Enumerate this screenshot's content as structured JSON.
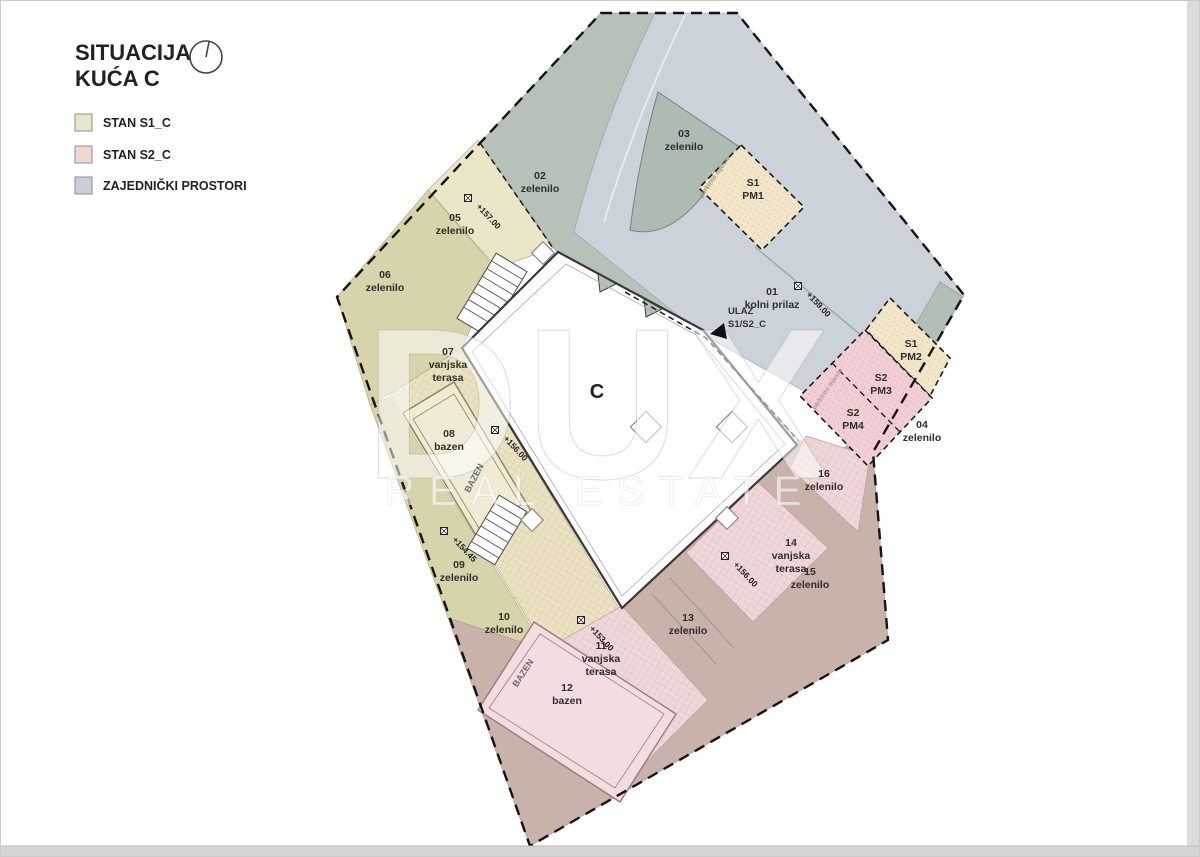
{
  "title": {
    "line1": "SITUACIJA",
    "line2": "KUĆA C"
  },
  "legend": {
    "items": [
      {
        "label": "STAN S1_C",
        "color": "#e9e5c9"
      },
      {
        "label": "STAN S2_C",
        "color": "#eed7d0"
      },
      {
        "label": "ZAJEDNIČKI PROSTORI",
        "color": "#c7cfd8"
      }
    ]
  },
  "watermark": {
    "line1": "DUX",
    "line2": "REAL ESTATE"
  },
  "building": {
    "label": "C"
  },
  "entrance": {
    "line1": "ULAZ",
    "line2": "S1/S2_C"
  },
  "pool_label": "BAZEN",
  "parking_note": "parkirno mjesto",
  "zones": {
    "z01": {
      "lines": [
        "01",
        "kolni prilaz"
      ]
    },
    "z02": {
      "lines": [
        "02",
        "zelenilo"
      ]
    },
    "z03": {
      "lines": [
        "03",
        "zelenilo"
      ]
    },
    "z04": {
      "lines": [
        "04",
        "zelenilo"
      ]
    },
    "z05": {
      "lines": [
        "05",
        "zelenilo"
      ]
    },
    "z06": {
      "lines": [
        "06",
        "zelenilo"
      ]
    },
    "z07": {
      "lines": [
        "07",
        "vanjska",
        "terasa"
      ]
    },
    "z08": {
      "lines": [
        "08",
        "bazen"
      ]
    },
    "z09": {
      "lines": [
        "09",
        "zelenilo"
      ]
    },
    "z10": {
      "lines": [
        "10",
        "zelenilo"
      ]
    },
    "z11": {
      "lines": [
        "11",
        "vanjska",
        "terasa"
      ]
    },
    "z12": {
      "lines": [
        "12",
        "bazen"
      ]
    },
    "z13": {
      "lines": [
        "13",
        "zelenilo"
      ]
    },
    "z14": {
      "lines": [
        "14",
        "vanjska",
        "terasa"
      ]
    },
    "z15": {
      "lines": [
        "15",
        "zelenilo"
      ]
    },
    "z16": {
      "lines": [
        "16",
        "zelenilo"
      ]
    }
  },
  "parking": {
    "pm1": {
      "lines": [
        "S1",
        "PM1"
      ]
    },
    "pm2": {
      "lines": [
        "S1",
        "PM2"
      ]
    },
    "pm3": {
      "lines": [
        "S2",
        "PM3"
      ]
    },
    "pm4": {
      "lines": [
        "S2",
        "PM4"
      ]
    }
  },
  "elevations": {
    "e01": "+159.00",
    "e05": "+157.00",
    "e08": "+156.00",
    "e09": "+154.45",
    "e11": "+153.00",
    "e14": "+156.00"
  }
}
